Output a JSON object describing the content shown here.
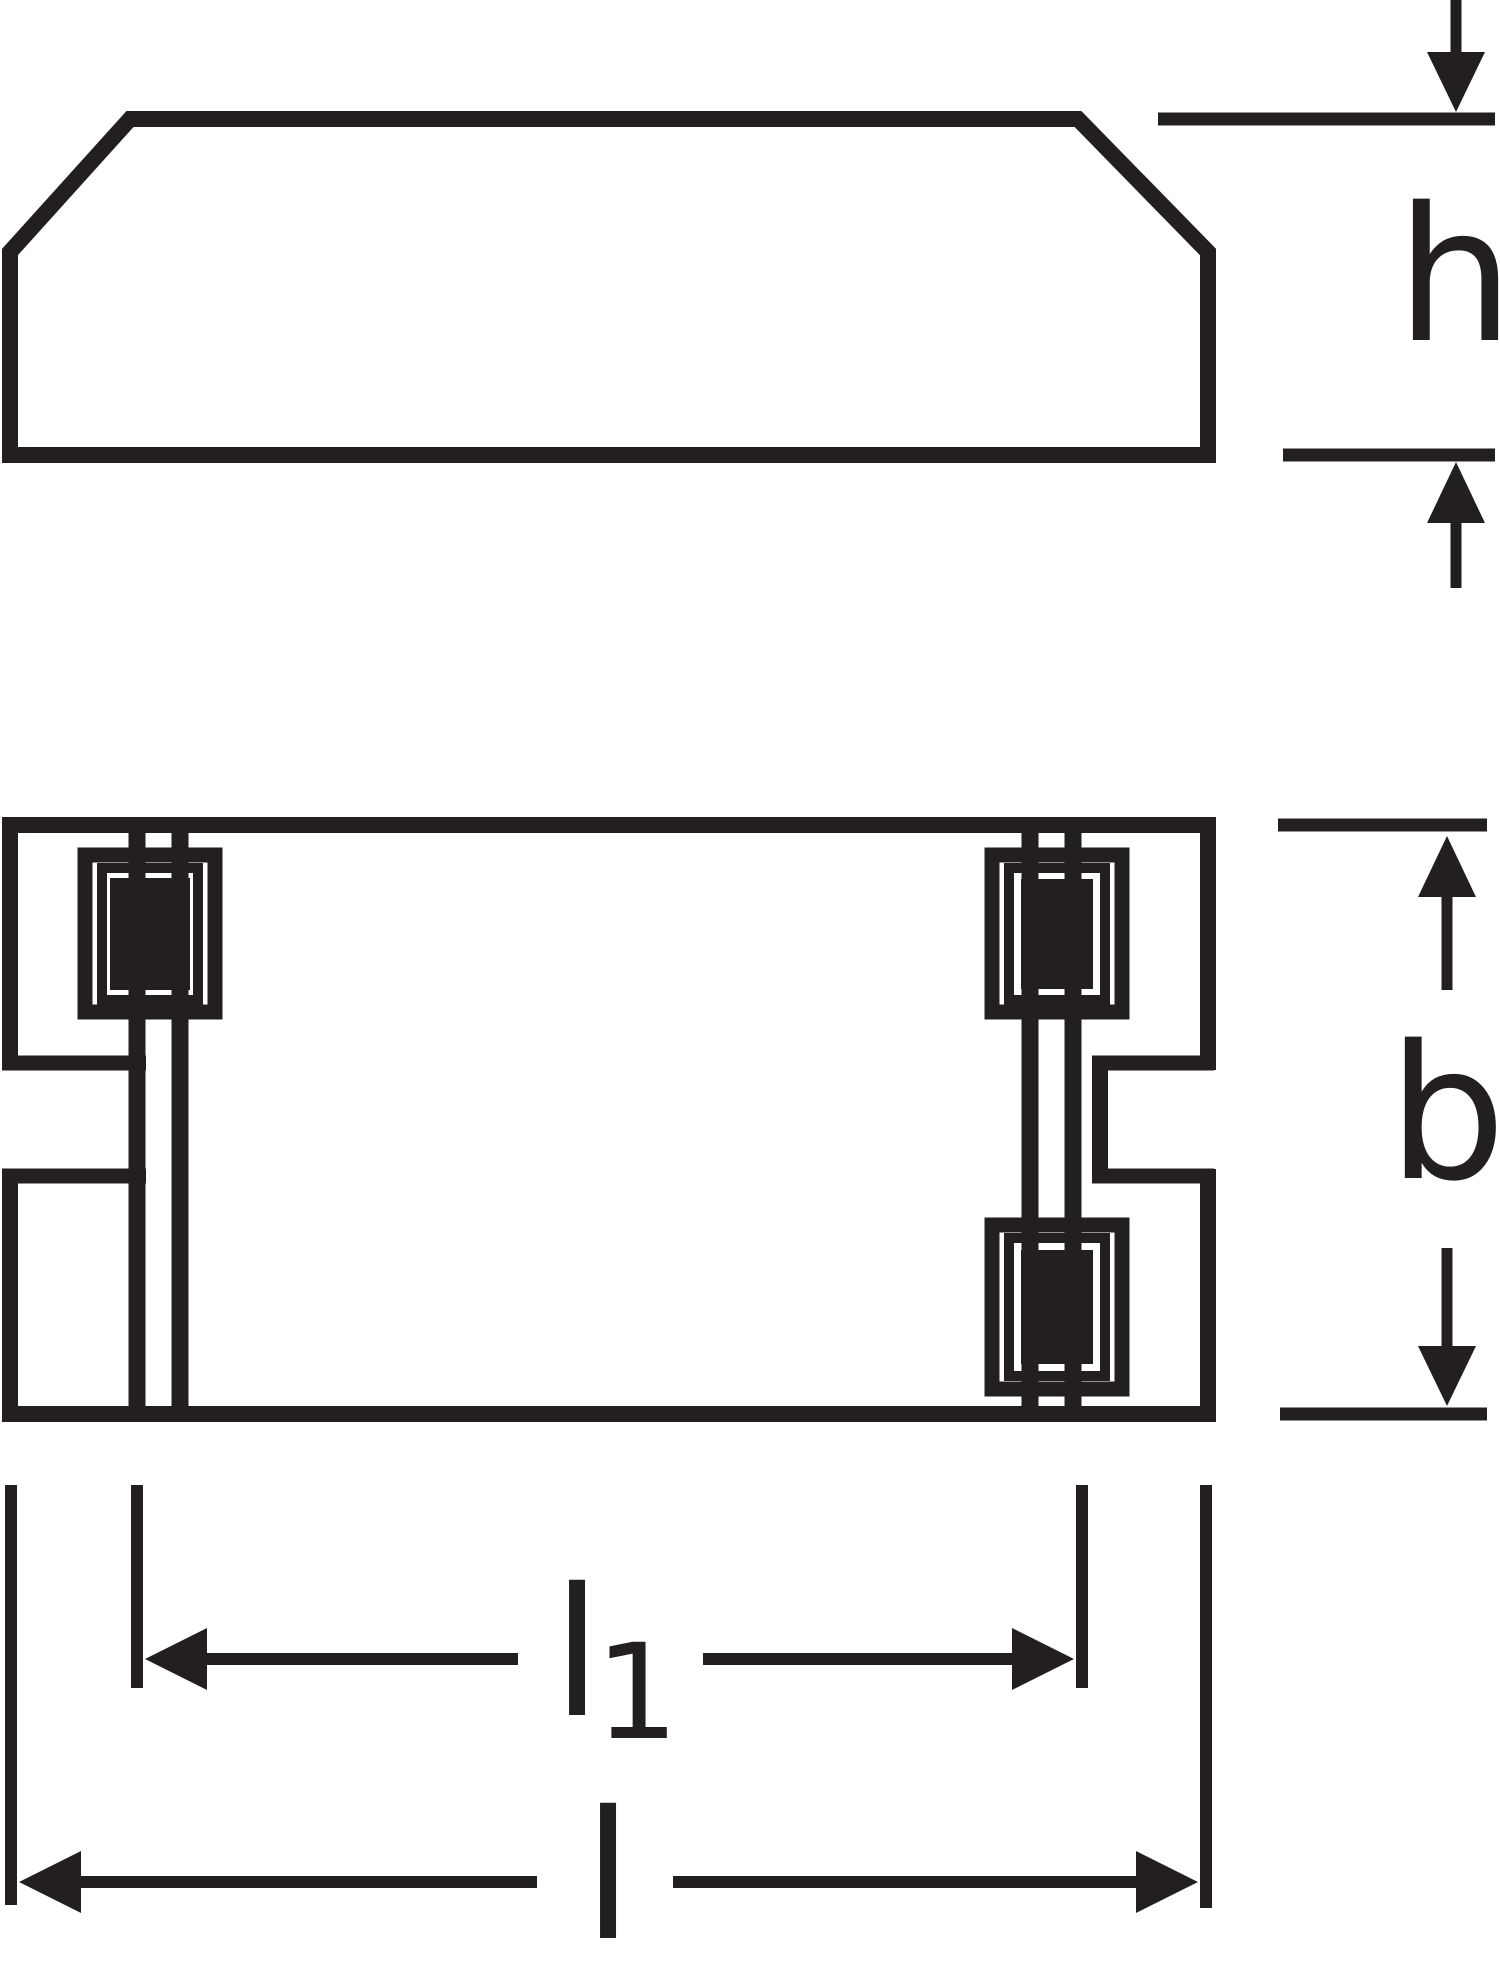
{
  "colors": {
    "ink": "#231f20",
    "background": "#ffffff"
  },
  "labels": {
    "height": "h",
    "width": "b",
    "mounting_length": {
      "base": "l",
      "subscript": "1"
    },
    "overall_length": "l"
  }
}
